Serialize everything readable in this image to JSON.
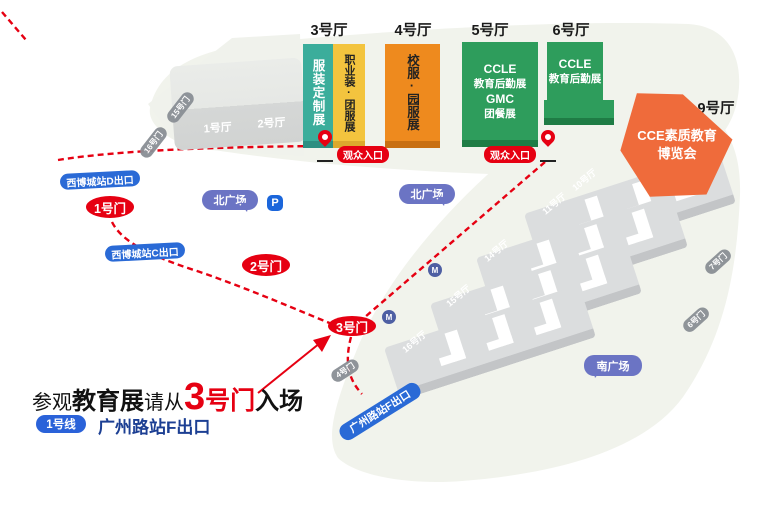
{
  "map": {
    "hall_labels": {
      "h1": "1号厅",
      "h2": "2号厅",
      "h3": "3号厅",
      "h4": "4号厅",
      "h5": "5号厅",
      "h6": "6号厅",
      "h9": "9号厅"
    },
    "exhibitions": {
      "garment_custom": "服装定制展",
      "uniform_team": "职业装·团服展",
      "school_uniform": "校服·园服展",
      "h5_lines": {
        "l1": "CCLE",
        "l2": "教育后勤展",
        "l3": "GMC",
        "l4": "团餐展"
      },
      "h6_lines": {
        "l1": "CCLE",
        "l2": "教育后勤展"
      },
      "h9_lines": {
        "l1": "CCE素质教育",
        "l2": "博览会"
      }
    },
    "south_hall_labels": {
      "h10": "10号厅",
      "h11": "11号厅",
      "h14": "14号厅",
      "h15": "15号厅",
      "h16": "16号厅"
    },
    "gates": {
      "g1": "1号门",
      "g2": "2号门",
      "g3": "3号门"
    },
    "road_gates": {
      "g15": "15号门",
      "g16": "16号门",
      "g7": "7号门",
      "g6": "6号门",
      "g4": "4号门"
    },
    "metro_exits": {
      "d": "西博城站D出口",
      "c": "西博城站C出口",
      "f": "广州路站F出口"
    },
    "plazas": {
      "north": "北广场",
      "south": "南广场"
    },
    "visitor_entrance": "观众入口",
    "parking": "P",
    "metro_icon": "M"
  },
  "note": {
    "seg1": "参观",
    "seg2": "教育展",
    "seg3": "请从",
    "seg4_num": "3",
    "seg4_rest": "号门",
    "seg5": "入场",
    "line_badge": "1号线",
    "station": "广州路站F出口"
  },
  "colors": {
    "route_red": "#E60012",
    "teal": "#3BAD9B",
    "yellow": "#F3C43E",
    "orange": "#EE8A1E",
    "green": "#2E9D5C",
    "orange_deep": "#EF6B3B",
    "metro_blue": "#2A6AD6",
    "plaza_purple": "#6B74C4",
    "navy_text": "#1C3F93",
    "hall_gray": "#DBDDDE"
  }
}
